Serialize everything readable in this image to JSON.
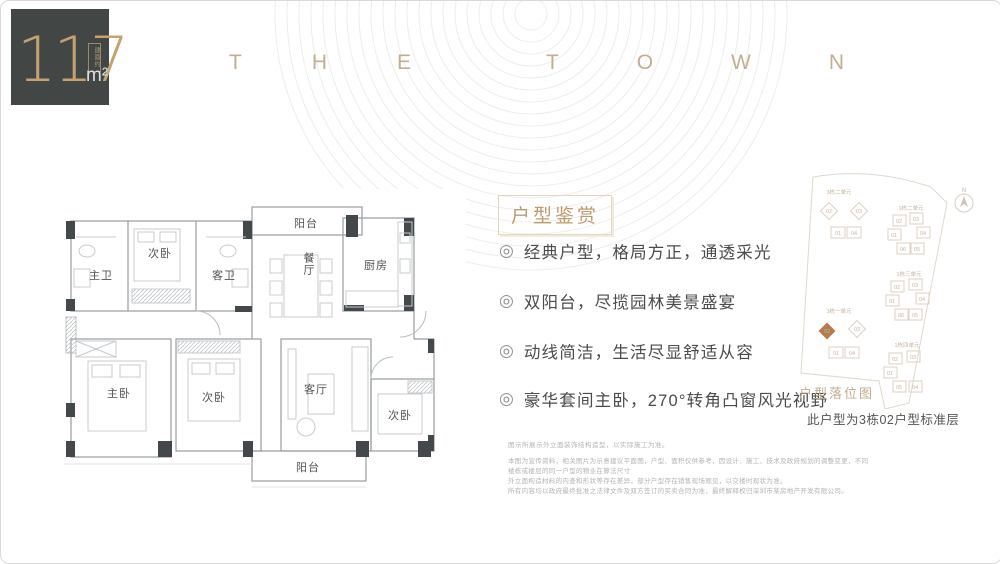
{
  "badge": {
    "value": "117",
    "unit": "m²",
    "note": "建面约"
  },
  "brand": {
    "word1": [
      "T",
      "H",
      "E"
    ],
    "word2": [
      "T",
      "O",
      "W",
      "N"
    ]
  },
  "floorplan": {
    "rooms": [
      {
        "label": "阳台"
      },
      {
        "label": "次卧"
      },
      {
        "label": "主卫"
      },
      {
        "label": "客卫"
      },
      {
        "label": "餐厅"
      },
      {
        "label": "厨房"
      },
      {
        "label": "主卧"
      },
      {
        "label": "次卧"
      },
      {
        "label": "客厅"
      },
      {
        "label": "次卧"
      },
      {
        "label": "阳台"
      }
    ]
  },
  "highlights": {
    "title": "户型鉴赏",
    "bullet_icon": "◎",
    "items": [
      "经典户型，格局方正，通透采光",
      "双阳台，尽揽园林美景盛宴",
      "动线简洁，生活尽显舒适从容",
      "豪华套间主卧，270°转角凸窗风光视野"
    ]
  },
  "sitemap": {
    "caption": "户型落位图",
    "note": "此户型为3栋02户型标准层",
    "compass_label": "N",
    "highlight_color": "#b57c4e",
    "clusters": [
      {
        "label": "3栋二单元",
        "units": [
          "02",
          "03",
          "01",
          "04"
        ]
      },
      {
        "label": "1栋二单元",
        "units": [
          "02",
          "03",
          "01",
          "04",
          "06",
          "05"
        ]
      },
      {
        "label": "3栋一单元",
        "units": [
          "02",
          "03",
          "01",
          "04"
        ],
        "highlight": "02"
      },
      {
        "label": "1栋三单元",
        "units": [
          "02",
          "03",
          "01",
          "04",
          "06",
          "05"
        ]
      },
      {
        "label": "1栋四单元",
        "units": [
          "02",
          "03",
          "01",
          "05",
          "04"
        ]
      }
    ]
  },
  "disclaimer": {
    "line1": "图示所展示外立面装饰结构造型，以实际施工为准。",
    "lines": [
      "本图为宣传资料，相关图片为示意建议平面图，户型、面积仅供参考，因设计、施工、技术及政府规划的调整变更，不同楼栋或楼层的同一户型的物业在算法尺寸",
      "外立面构造材料的内查和形状等存在差异，部分户型存在销售现场观见，以交楼时现状为准。",
      "所有内容均以政府最终批准之法律文件及双方签订的买卖合同为准，最终解释权归深圳市某房地产开发有限公司。"
    ]
  }
}
